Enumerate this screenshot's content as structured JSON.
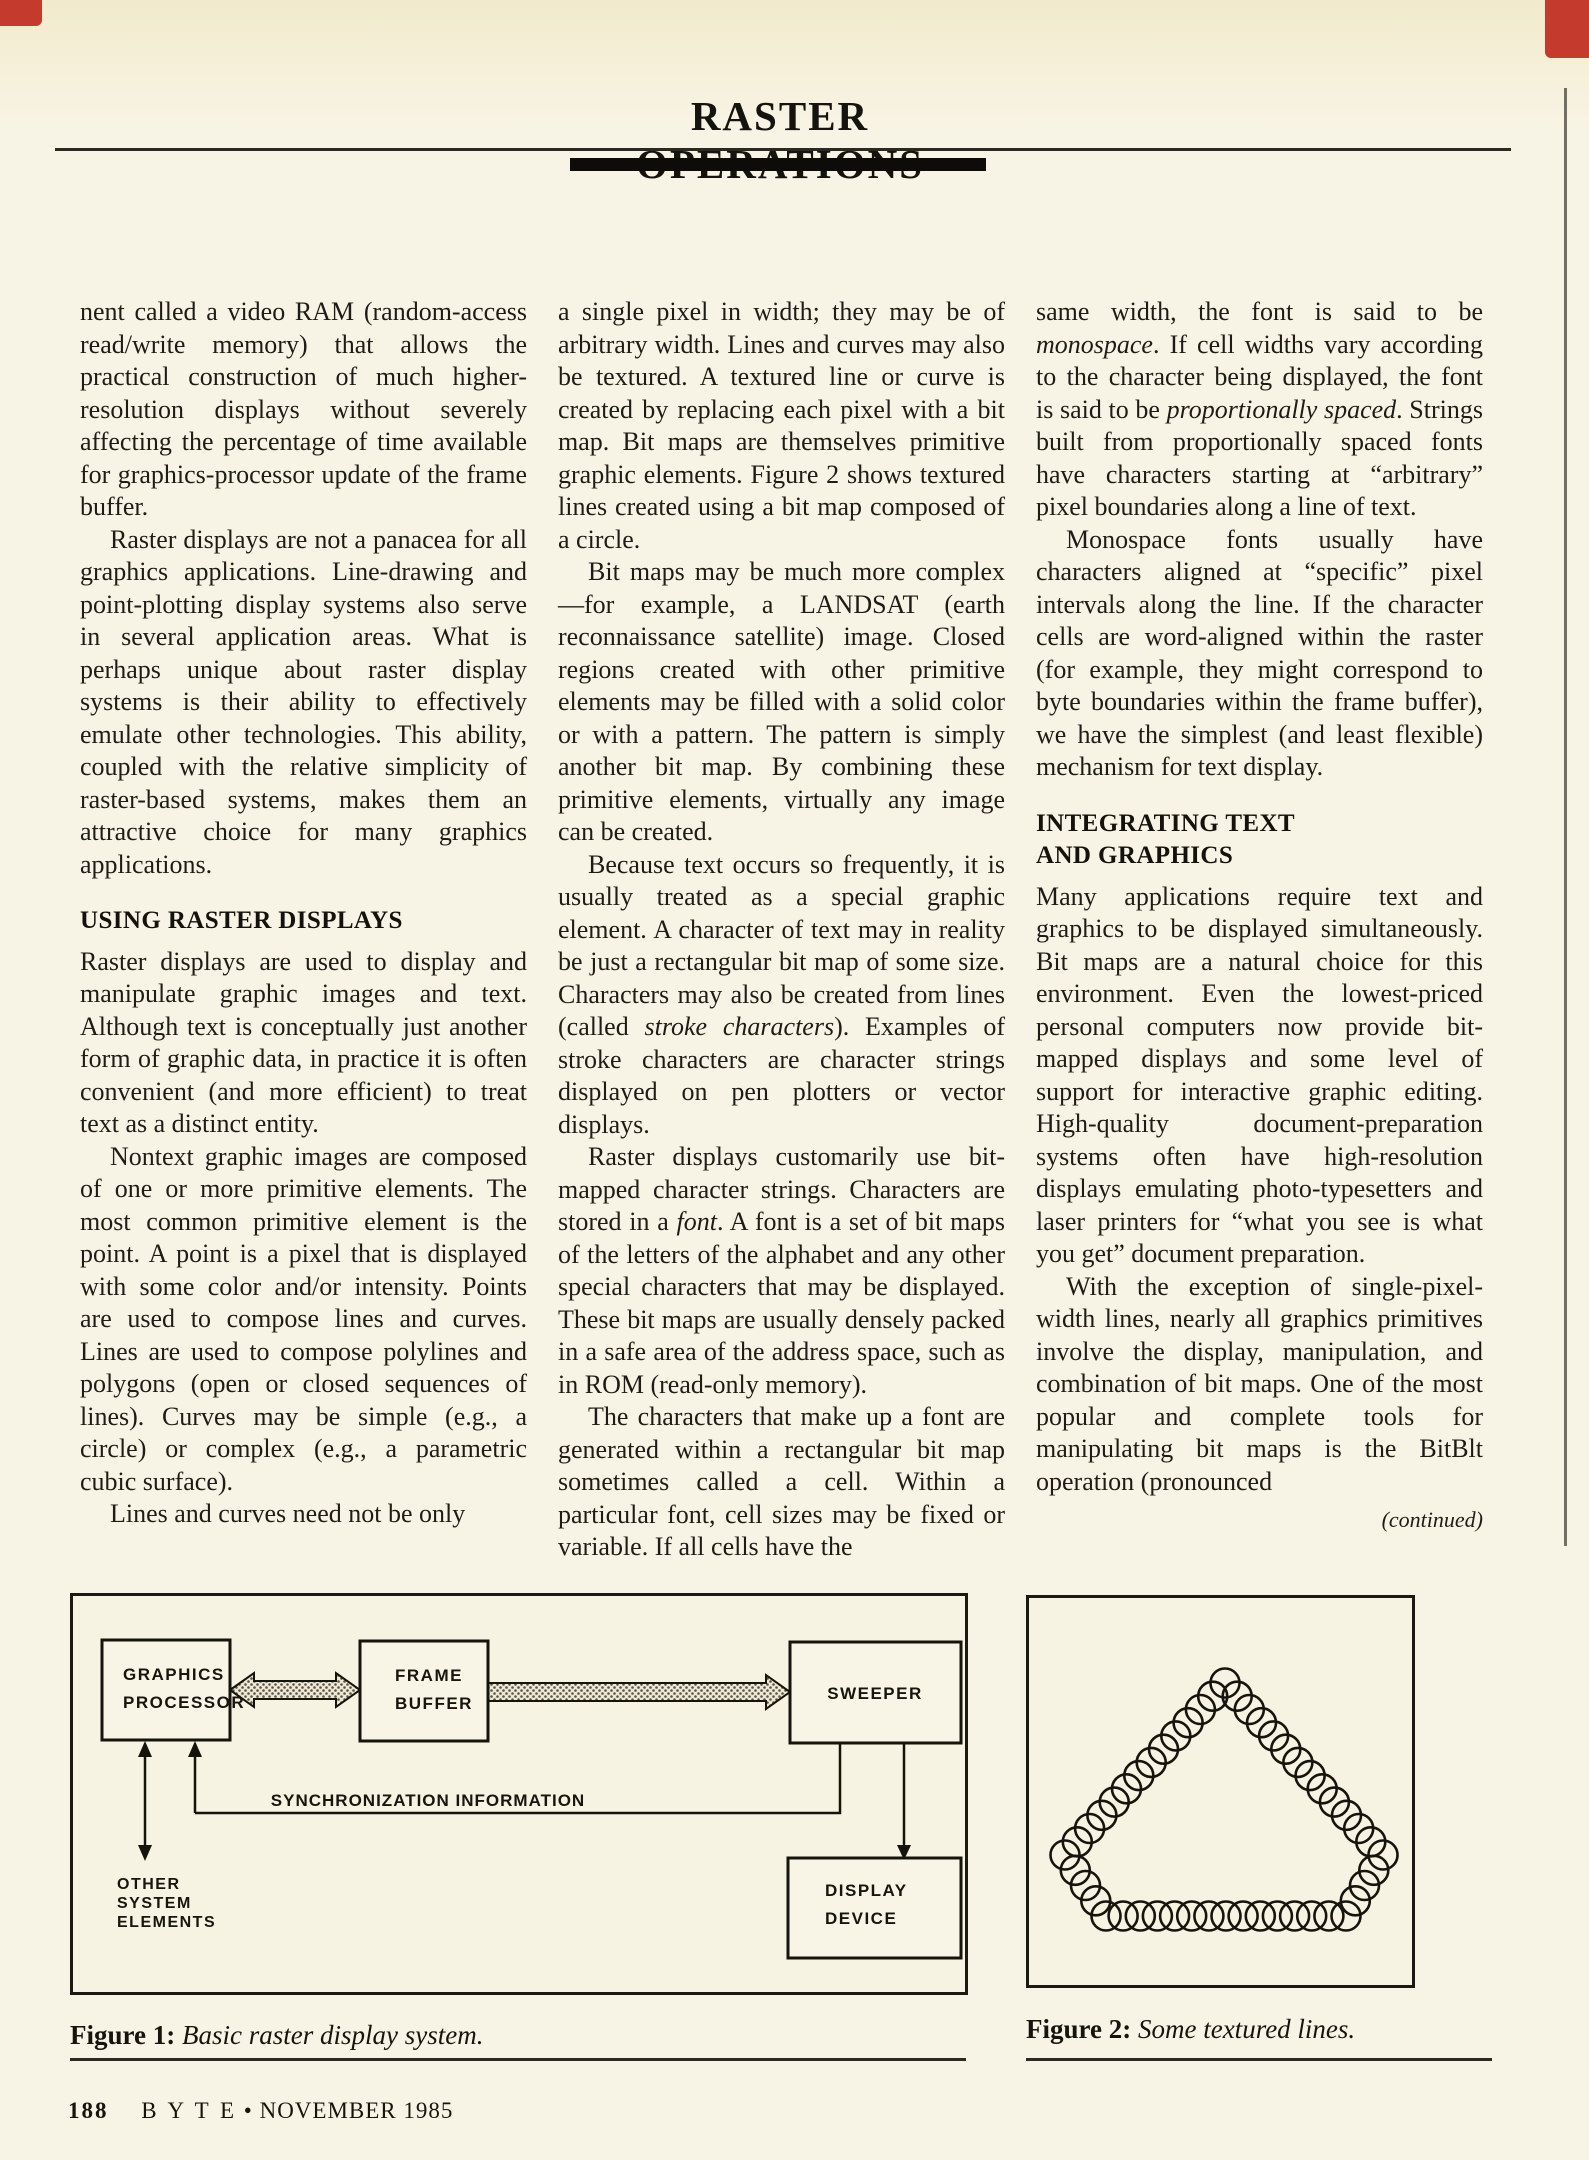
{
  "header": {
    "title": "RASTER OPERATIONS"
  },
  "columns": [
    {
      "blocks": [
        {
          "type": "p",
          "indent": false,
          "runs": [
            {
              "t": "nent called a video RAM (random-access read/write memory) that allows the practical construction of much higher-resolution displays without severely affecting the percentage of time available for graphics-processor update of the frame buffer."
            }
          ]
        },
        {
          "type": "p",
          "indent": true,
          "runs": [
            {
              "t": "Raster displays are not a panacea for all graphics applications. Line-drawing and point-plotting display systems also serve in several application areas. What is perhaps unique about raster display systems is their ability to effectively emulate other technologies. This ability, coupled with the relative simplicity of raster-based systems, makes them an attractive choice for many graphics applications."
            }
          ]
        },
        {
          "type": "h",
          "text": "USING RASTER DISPLAYS"
        },
        {
          "type": "p",
          "indent": false,
          "runs": [
            {
              "t": "Raster displays are used to display and manipulate graphic images and text. Although text is conceptually just another form of graphic data, in practice it is often convenient (and more efficient) to treat text as a distinct entity."
            }
          ]
        },
        {
          "type": "p",
          "indent": true,
          "runs": [
            {
              "t": "Nontext graphic images are composed of one or more primitive elements. The most common primitive element is the point. A point is a pixel that is displayed with some color and/or intensity. Points are used to compose lines and curves. Lines are used to compose polylines and polygons (open or closed sequences of lines). Curves may be simple (e.g., a circle) or complex (e.g., a parametric cubic surface)."
            }
          ]
        },
        {
          "type": "p",
          "indent": true,
          "runs": [
            {
              "t": "Lines and curves need not be only"
            }
          ]
        }
      ]
    },
    {
      "blocks": [
        {
          "type": "p",
          "indent": false,
          "runs": [
            {
              "t": "a single pixel in width; they may be of arbitrary width. Lines and curves may also be textured. A textured line or curve is created by replacing each pixel with a bit map. Bit maps are themselves primitive graphic elements. Figure 2 shows textured lines created using a bit map composed of a circle."
            }
          ]
        },
        {
          "type": "p",
          "indent": true,
          "runs": [
            {
              "t": "Bit maps may be much more complex—for example, a LANDSAT (earth reconnaissance satellite) image. Closed regions created with other primitive elements may be filled with a solid color or with a pattern. The pattern is simply another bit map. By combining these primitive elements, virtually any image can be created."
            }
          ]
        },
        {
          "type": "p",
          "indent": true,
          "runs": [
            {
              "t": "Because text occurs so frequently, it is usually treated as a special graphic element. A character of text may in reality be just a rectangular bit map of some size. Characters may also be created from lines (called "
            },
            {
              "t": "stroke characters",
              "i": true
            },
            {
              "t": "). Examples of stroke characters are character strings displayed on pen plotters or vector displays."
            }
          ]
        },
        {
          "type": "p",
          "indent": true,
          "runs": [
            {
              "t": "Raster displays customarily use bit-mapped character strings. Characters are stored in a "
            },
            {
              "t": "font",
              "i": true
            },
            {
              "t": ". A font is a set of bit maps of the letters of the alphabet and any other special characters that may be displayed. These bit maps are usually densely packed in a safe area of the address space, such as in ROM (read-only memory)."
            }
          ]
        },
        {
          "type": "p",
          "indent": true,
          "runs": [
            {
              "t": "The characters that make up a font are generated within a rectangular bit map sometimes called a cell. Within a particular font, cell sizes may be fixed or variable. If all cells have the"
            }
          ]
        }
      ]
    },
    {
      "blocks": [
        {
          "type": "p",
          "indent": false,
          "runs": [
            {
              "t": "same width, the font is said to be "
            },
            {
              "t": "monospace",
              "i": true
            },
            {
              "t": ". If cell widths vary according to the character being displayed, the font is said to be "
            },
            {
              "t": "proportionally spaced",
              "i": true
            },
            {
              "t": ". Strings built from proportionally spaced fonts have characters starting at “arbitrary” pixel boundaries along a line of text."
            }
          ]
        },
        {
          "type": "p",
          "indent": true,
          "runs": [
            {
              "t": "Monospace fonts usually have characters aligned at “specific” pixel intervals along the line. If the character cells are word-aligned within the raster (for example, they might correspond to byte boundaries within the frame buffer), we have the simplest (and least flexible) mechanism for text display."
            }
          ]
        },
        {
          "type": "h",
          "text": "INTEGRATING TEXT\nAND GRAPHICS"
        },
        {
          "type": "p",
          "indent": false,
          "runs": [
            {
              "t": "Many applications require text and graphics to be displayed simultaneously. Bit maps are a natural choice for this environment. Even the lowest-priced personal computers now provide bit-mapped displays and some level of support for interactive graphic editing. High-quality document-preparation systems often have high-resolution displays emulating photo-typesetters and laser printers for “what you see is what you get” document preparation."
            }
          ]
        },
        {
          "type": "p",
          "indent": true,
          "runs": [
            {
              "t": "With the exception of single-pixel-width lines, nearly all graphics primitives involve the display, manipulation, and combination of bit maps. One of the most popular and complete tools for manipulating bit maps is the BitBlt operation (pronounced"
            }
          ]
        }
      ]
    }
  ],
  "continued": "(continued)",
  "figure1": {
    "caption_label": "Figure 1:",
    "caption_text": "Basic raster display system.",
    "labels": {
      "gp1": "GRAPHICS",
      "gp2": "PROCESSOR",
      "fb1": "FRAME",
      "fb2": "BUFFER",
      "sweeper": "SWEEPER",
      "dd1": "DISPLAY",
      "dd2": "DEVICE",
      "sync": "SYNCHRONIZATION INFORMATION",
      "os1": "OTHER",
      "os2": "SYSTEM",
      "os3": "ELEMENTS"
    }
  },
  "figure2": {
    "caption_label": "Figure 2:",
    "caption_text": "Some textured lines."
  },
  "footer": {
    "page_number": "188",
    "magazine": "B Y T E",
    "bullet": "•",
    "issue": "NOVEMBER 1985"
  }
}
